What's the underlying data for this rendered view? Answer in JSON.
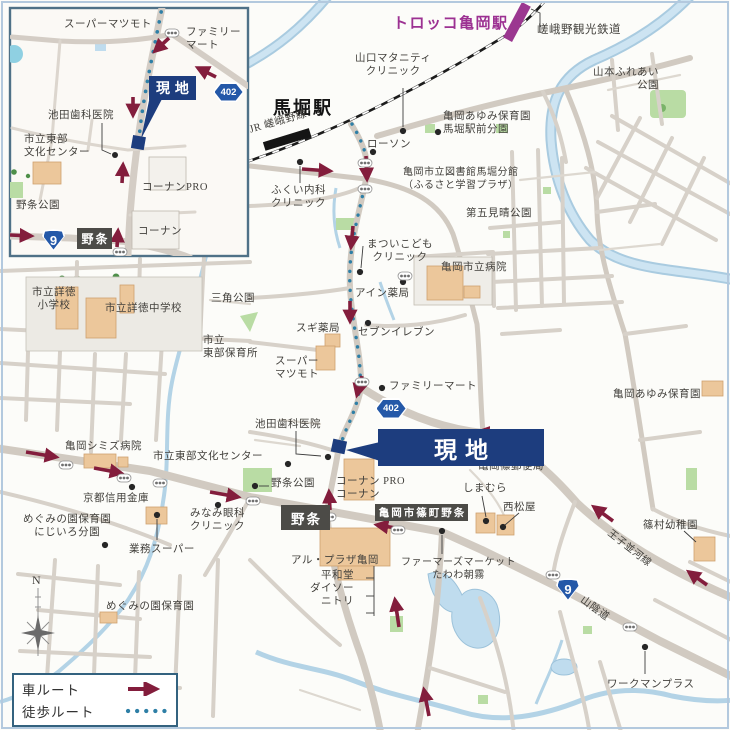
{
  "colors": {
    "car_route": "#831d3c",
    "walk_route": "#2e7fa6",
    "site_box": "#1d3d7e",
    "area_box": "#4c4b47",
    "route_badge_blue": "#2458a8",
    "station_purple": "#9c3192",
    "railway_black": "#1c1c1c",
    "map_border": "#b3c9de",
    "inset_border": "#4f7187",
    "road_gray": "#d1cac1",
    "river_blue": "#b9d7ea",
    "park_green": "#b9dca4",
    "building_tan": "#ecc79b"
  },
  "legend": {
    "car_label": "車ルート",
    "walk_label": "徒歩ルート"
  },
  "map": {
    "labels": [
      {
        "name": "supermatsumoto-inset-label",
        "text": "スーパーマツモト",
        "x": 64,
        "y": 18
      },
      {
        "name": "familymart-inset-label",
        "text": "ファミリー\nマート",
        "x": 186,
        "y": 26
      },
      {
        "name": "ikeda-dental-inset-label",
        "text": "池田歯科医院",
        "x": 48,
        "y": 109
      },
      {
        "name": "bunka-center-inset-label",
        "text": "市立東部\n文化センター",
        "x": 24,
        "y": 133
      },
      {
        "name": "nojo-park-inset-label",
        "text": "野条公園",
        "x": 16,
        "y": 199
      },
      {
        "name": "kohnan-pro-inset-label",
        "text": "コーナンPRO",
        "x": 142,
        "y": 181
      },
      {
        "name": "kohnan-inset-label",
        "text": "コーナン",
        "x": 138,
        "y": 225
      },
      {
        "name": "torokko-station-label",
        "text": "トロッコ亀岡駅",
        "x": 393,
        "y": 15,
        "cls": "sta-purple"
      },
      {
        "name": "sagano-scenic-railway-label",
        "text": "嵯峨野観光鉄道",
        "x": 537,
        "y": 23,
        "size": 11.5
      },
      {
        "name": "yamaguchi-maternity-label",
        "text": "山口マタニティ\nクリニック",
        "x": 355,
        "y": 52,
        "align": "center"
      },
      {
        "name": "umahori-station-label",
        "text": "馬堀駅",
        "x": 273,
        "y": 97,
        "cls": "sta-black"
      },
      {
        "name": "jr-sagano-line-label",
        "text": "JR 嵯峨野線",
        "x": 248,
        "y": 124,
        "rotate": -16
      },
      {
        "name": "ayumi-nursery-top-label",
        "text": "亀岡あゆみ保育園\n馬堀駅前分園",
        "x": 443,
        "y": 110
      },
      {
        "name": "yamamoto-fureai-park-label",
        "text": "山本ふれあい\n公園",
        "x": 593,
        "y": 66,
        "align": "right"
      },
      {
        "name": "lawson-label",
        "text": "ローソン",
        "x": 367,
        "y": 138
      },
      {
        "name": "library-umahori-label",
        "text": "亀岡市立図書館馬堀分館\n（ふるさと学習プラザ）",
        "x": 403,
        "y": 167,
        "size": 10
      },
      {
        "name": "fukui-clinic-label",
        "text": "ふくい内科\nクリニック",
        "x": 271,
        "y": 184
      },
      {
        "name": "daigo-miharashi-park-label",
        "text": "第五見晴公園",
        "x": 466,
        "y": 207
      },
      {
        "name": "matsui-kids-clinic-label",
        "text": "まついこども\nクリニック",
        "x": 367,
        "y": 238,
        "align": "center"
      },
      {
        "name": "municipal-hospital-label",
        "text": "亀岡市立病院",
        "x": 441,
        "y": 261
      },
      {
        "name": "ain-pharmacy-label",
        "text": "アイン薬局",
        "x": 355,
        "y": 287
      },
      {
        "name": "sankaku-park-label",
        "text": "三角公園",
        "x": 211,
        "y": 292
      },
      {
        "name": "shotoku-elementary-label",
        "text": "市立詳徳\n小学校",
        "x": 32,
        "y": 286,
        "align": "center"
      },
      {
        "name": "shotoku-junior-high-label",
        "text": "市立詳徳中学校",
        "x": 105,
        "y": 302
      },
      {
        "name": "sugi-pharmacy-label",
        "text": "スギ薬局",
        "x": 296,
        "y": 322
      },
      {
        "name": "seven-eleven-label",
        "text": "セブンイレブン",
        "x": 358,
        "y": 326
      },
      {
        "name": "tobu-nursery-label",
        "text": "市立\n東部保育所",
        "x": 203,
        "y": 334
      },
      {
        "name": "supermatsumoto-main-label",
        "text": "スーパー\nマツモト",
        "x": 275,
        "y": 355
      },
      {
        "name": "familymart-main-label",
        "text": "ファミリーマート",
        "x": 389,
        "y": 380
      },
      {
        "name": "ayumi-nursery-right-label",
        "text": "亀岡あゆみ保育園",
        "x": 613,
        "y": 388
      },
      {
        "name": "ikeda-dental-main-label",
        "text": "池田歯科医院",
        "x": 255,
        "y": 418
      },
      {
        "name": "bunka-center-main-label",
        "text": "市立東部文化センター",
        "x": 153,
        "y": 450
      },
      {
        "name": "shimizu-hospital-label",
        "text": "亀岡シミズ病院",
        "x": 65,
        "y": 440
      },
      {
        "name": "nojo-park-main-label",
        "text": "野条公園",
        "x": 271,
        "y": 477
      },
      {
        "name": "kohnan-main-label",
        "text": "コーナン PRO\nコーナン",
        "x": 336,
        "y": 475
      },
      {
        "name": "shino-post-office-label",
        "text": "亀岡篠郵便局",
        "x": 478,
        "y": 460
      },
      {
        "name": "shimamura-label",
        "text": "しまむら",
        "x": 463,
        "y": 482
      },
      {
        "name": "kyoto-shinkin-bank-label",
        "text": "京都信用金庫",
        "x": 83,
        "y": 492
      },
      {
        "name": "nishimatsuya-label",
        "text": "西松屋",
        "x": 503,
        "y": 501
      },
      {
        "name": "megumi-nijiiro-label",
        "text": "めぐみの園保育園\nにじいろ分園",
        "x": 23,
        "y": 513,
        "align": "center"
      },
      {
        "name": "minami-eye-clinic-label",
        "text": "みなみ眼科\nクリニック",
        "x": 190,
        "y": 507
      },
      {
        "name": "gyomu-super-label",
        "text": "業務スーパー",
        "x": 129,
        "y": 543
      },
      {
        "name": "al-plaza-kameoka-label",
        "text": "アル・プラザ亀岡",
        "x": 291,
        "y": 554
      },
      {
        "name": "heiwado-daiso-nitori-label",
        "text": "平和堂\nダイソー\nニトリ",
        "x": 310,
        "y": 569,
        "align": "right"
      },
      {
        "name": "farmers-market-label",
        "text": "ファーマーズマーケット\nたわわ朝霧",
        "x": 401,
        "y": 557,
        "align": "center",
        "size": 10
      },
      {
        "name": "megumi-nursery-label",
        "text": "めぐみの園保育園",
        "x": 106,
        "y": 600
      },
      {
        "name": "shinomura-kindergarten-label",
        "text": "篠村幼稚園",
        "x": 643,
        "y": 519
      },
      {
        "name": "workman-plus-label",
        "text": "ワークマンプラス",
        "x": 607,
        "y": 678
      },
      {
        "name": "oji-namikawa-line-label",
        "text": "王子並河線",
        "x": 612,
        "y": 528,
        "rotate": 38,
        "size": 10
      },
      {
        "name": "sanin-do-label",
        "text": "山陰道",
        "x": 585,
        "y": 594,
        "rotate": 36
      },
      {
        "name": "compass-n-label",
        "text": "N",
        "x": 32,
        "y": 573,
        "size": 12
      }
    ],
    "boxes": [
      {
        "name": "site-box-inset",
        "text": "現地",
        "x": 149,
        "y": 76,
        "w": 47,
        "h": 24,
        "cls": "site",
        "size": 14
      },
      {
        "name": "site-box-main",
        "text": "現地",
        "x": 378,
        "y": 429,
        "w": 166,
        "h": 37,
        "cls": "site",
        "size": 23
      },
      {
        "name": "nojo-area-box-inset",
        "text": "野条",
        "x": 77,
        "y": 228,
        "w": 35,
        "h": 21,
        "cls": "area",
        "size": 12
      },
      {
        "name": "nojo-area-box-main",
        "text": "野条",
        "x": 281,
        "y": 505,
        "w": 49,
        "h": 25,
        "cls": "area",
        "size": 13.5
      },
      {
        "name": "shinomachi-nojo-area-box",
        "text": "亀岡市篠町野条",
        "x": 375,
        "y": 504,
        "w": 93,
        "h": 17,
        "cls": "area",
        "size": 10.5
      }
    ],
    "badges": [
      {
        "name": "route-402-badge-inset",
        "text": "402",
        "x": 213,
        "y": 82,
        "w": 31,
        "h": 20,
        "shape": "hex",
        "size": 9.5
      },
      {
        "name": "route-402-badge-main",
        "text": "402",
        "x": 375,
        "y": 398,
        "w": 32,
        "h": 21,
        "shape": "hex",
        "size": 9.5
      },
      {
        "name": "route-9-badge-inset",
        "text": "9",
        "x": 42,
        "y": 229,
        "w": 23,
        "h": 22,
        "shape": "shield",
        "size": 13
      },
      {
        "name": "route-9-badge-main",
        "text": "9",
        "x": 556,
        "y": 578,
        "w": 24,
        "h": 23,
        "shape": "shield",
        "size": 13
      }
    ]
  }
}
